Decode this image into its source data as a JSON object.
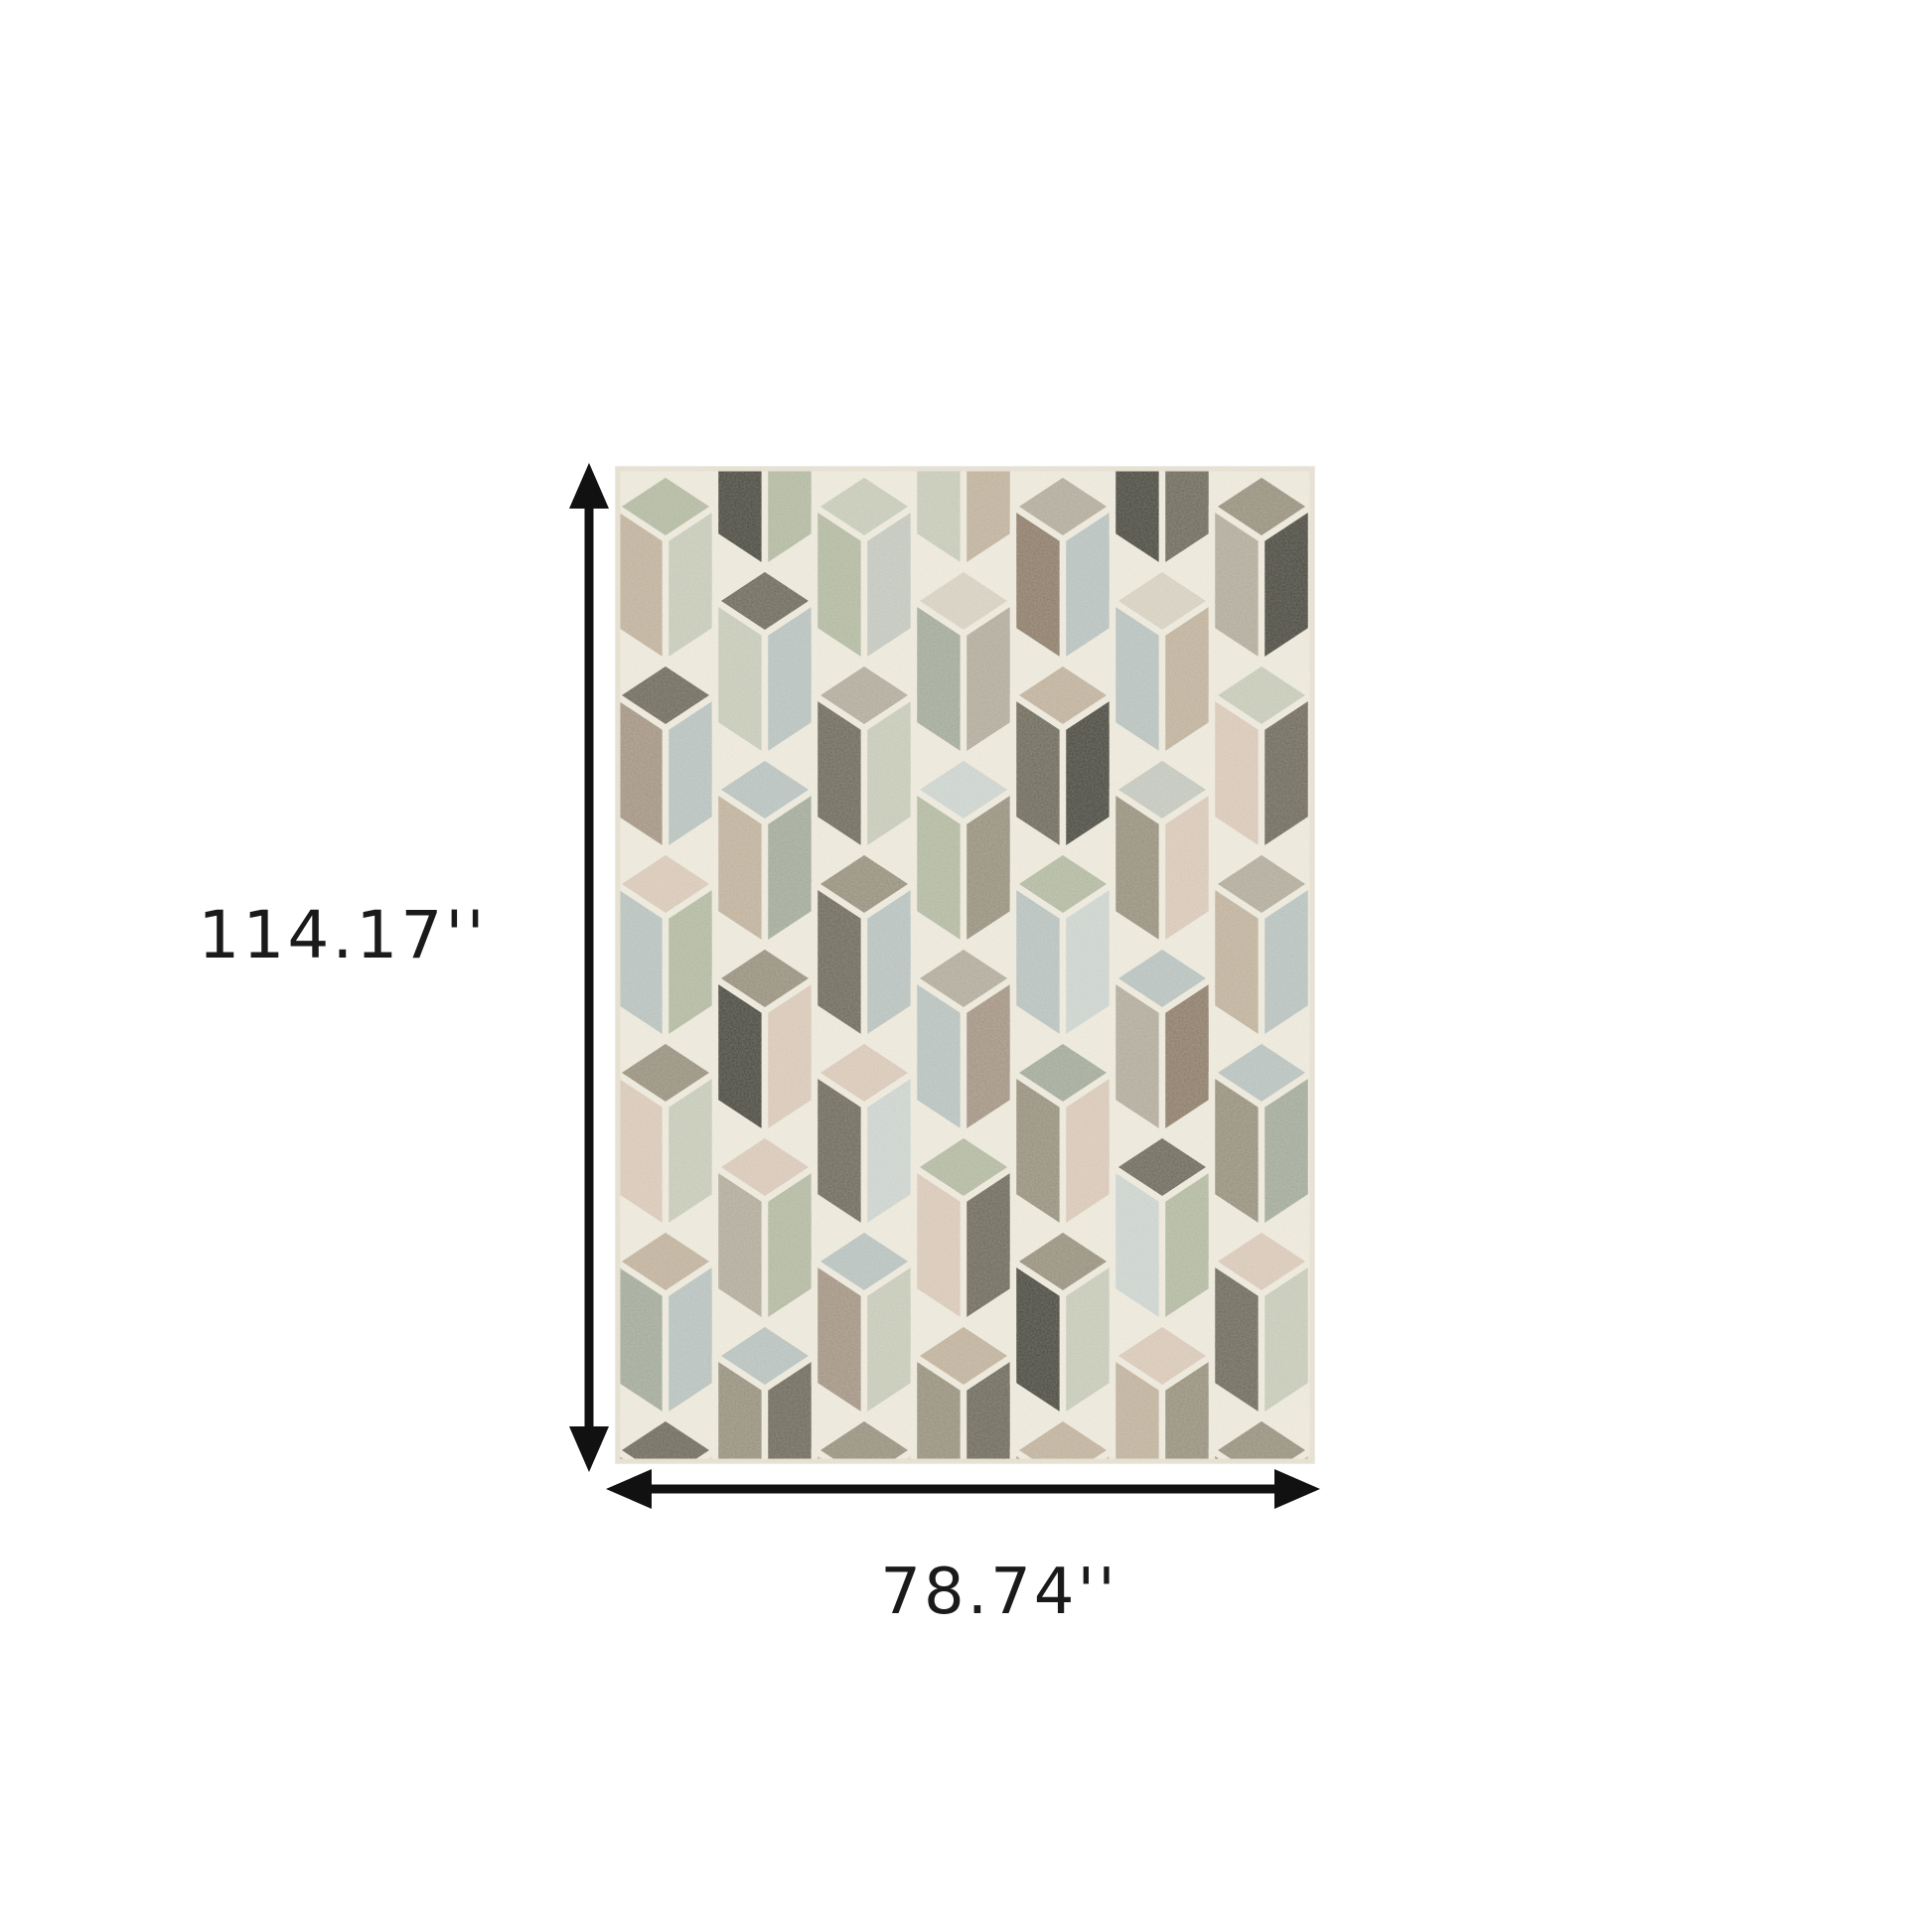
{
  "page": {
    "background": "#ffffff"
  },
  "dimensions": {
    "height_label": "114.17''",
    "width_label": "78.74''",
    "arrow_color": "#111111",
    "label_color": "#1a1a1a"
  },
  "rug": {
    "grout_color": "#f0ecdf",
    "edge_color": "#e6e1d2",
    "palette": [
      "#b4bba3",
      "#c9cdbb",
      "#b9c4c1",
      "#cfd6d2",
      "#d9d3c3",
      "#dccbbb",
      "#c2b39e",
      "#a59585",
      "#8e7d6a",
      "#98917f",
      "#6e6a5c",
      "#4a4940",
      "#b3ad9d",
      "#a4ac9c",
      "#c6cac1"
    ],
    "strips": [
      [
        [
          4,
          1,
          12
        ],
        [
          0,
          6,
          1
        ],
        [
          10,
          7,
          2
        ],
        [
          5,
          2,
          0
        ],
        [
          9,
          5,
          1
        ],
        [
          6,
          13,
          2
        ],
        [
          10,
          8,
          4
        ]
      ],
      [
        [
          12,
          11,
          0
        ],
        [
          10,
          1,
          2
        ],
        [
          2,
          6,
          13
        ],
        [
          9,
          11,
          5
        ],
        [
          5,
          12,
          0
        ],
        [
          2,
          9,
          10
        ],
        [
          4,
          4,
          4
        ]
      ],
      [
        [
          4,
          12,
          1
        ],
        [
          1,
          0,
          14
        ],
        [
          12,
          10,
          1
        ],
        [
          9,
          10,
          2
        ],
        [
          5,
          10,
          3
        ],
        [
          2,
          7,
          1
        ],
        [
          9,
          6,
          4
        ]
      ],
      [
        [
          9,
          1,
          6
        ],
        [
          4,
          13,
          12
        ],
        [
          3,
          0,
          9
        ],
        [
          12,
          2,
          7
        ],
        [
          0,
          5,
          10
        ],
        [
          6,
          9,
          10
        ],
        [
          4,
          4,
          4
        ]
      ],
      [
        [
          4,
          9,
          12
        ],
        [
          12,
          8,
          2
        ],
        [
          6,
          10,
          11
        ],
        [
          0,
          2,
          3
        ],
        [
          13,
          9,
          5
        ],
        [
          9,
          11,
          1
        ],
        [
          6,
          7,
          2
        ]
      ],
      [
        [
          12,
          11,
          10
        ],
        [
          4,
          2,
          6
        ],
        [
          14,
          9,
          5
        ],
        [
          2,
          12,
          8
        ],
        [
          10,
          3,
          0
        ],
        [
          5,
          6,
          9
        ],
        [
          4,
          4,
          4
        ]
      ],
      [
        [
          4,
          10,
          12
        ],
        [
          9,
          12,
          11
        ],
        [
          1,
          5,
          10
        ],
        [
          12,
          6,
          2
        ],
        [
          2,
          9,
          13
        ],
        [
          5,
          10,
          1
        ],
        [
          9,
          8,
          6
        ]
      ]
    ]
  }
}
